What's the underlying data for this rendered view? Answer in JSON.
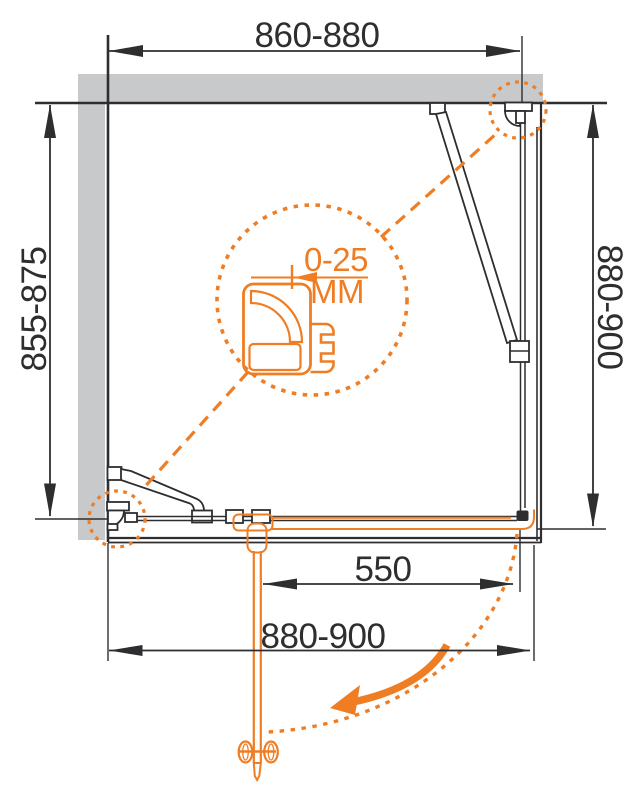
{
  "colors": {
    "accent": "#EF7D24",
    "wall_fill": "#C8C9CB",
    "line": "#2E2E30",
    "background": "#FFFFFF"
  },
  "diagram": {
    "type": "shower-enclosure-installation-plan",
    "dimensions": {
      "top_width": {
        "label": "860-880"
      },
      "left_depth": {
        "label": "855-875"
      },
      "right_depth": {
        "label": "880-900"
      },
      "door_width": {
        "label": "550"
      },
      "bottom_width": {
        "label": "880-900"
      }
    },
    "detail_callout": {
      "adjustment_range": "0-25",
      "unit": "ММ"
    }
  }
}
